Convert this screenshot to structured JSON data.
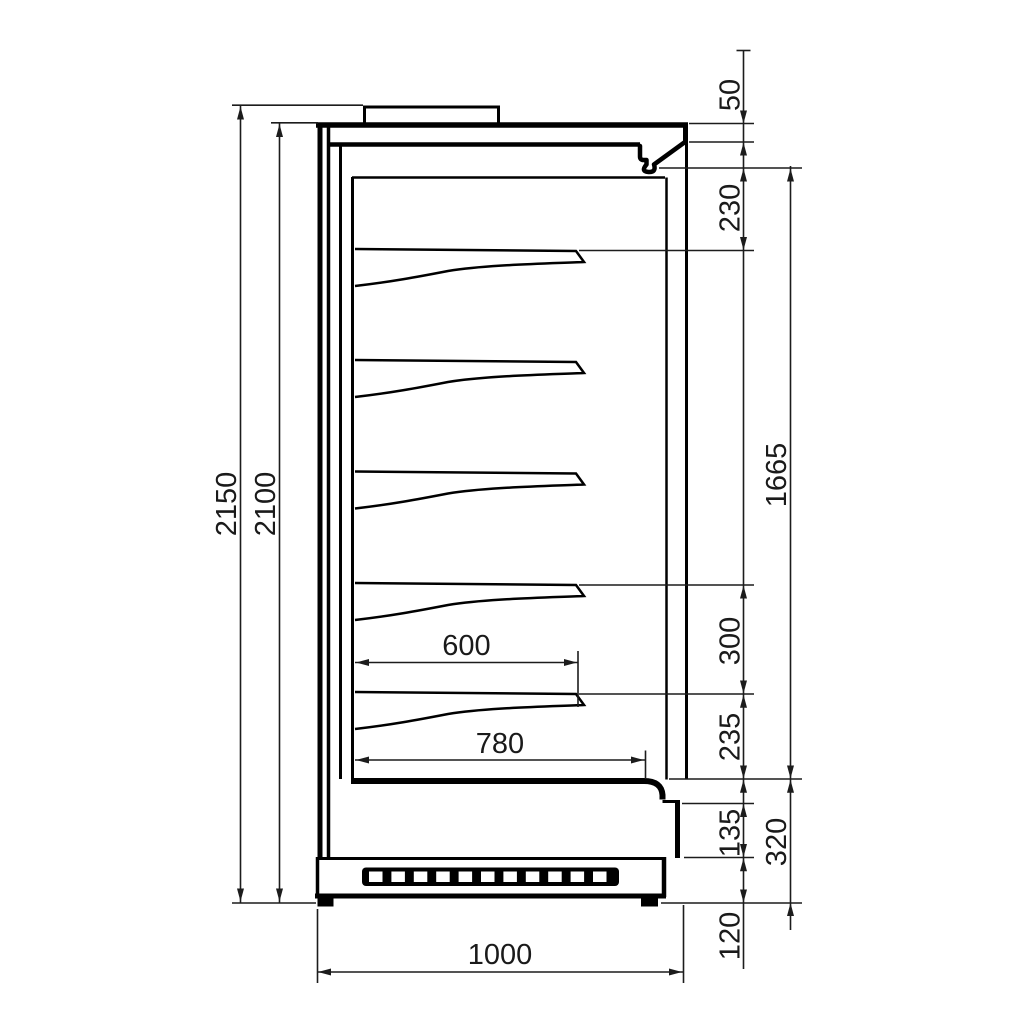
{
  "drawing": {
    "kind": "technical-dimension-drawing",
    "view": "side-section-of-multideck-display-cabinet",
    "units_shown": false,
    "dims": {
      "overall_height": "2150",
      "cabinet_height": "2100",
      "canopy_front_height": "50",
      "canopy_to_first_shelf": "230",
      "display_opening_height": "1665",
      "shelf_spacing": "300",
      "last_shelf_to_deck": "235",
      "front_panel_height": "135",
      "base_section_height": "320",
      "plinth_height": "120",
      "shelf_depth": "600",
      "deck_depth": "780",
      "overall_depth": "1000"
    }
  }
}
